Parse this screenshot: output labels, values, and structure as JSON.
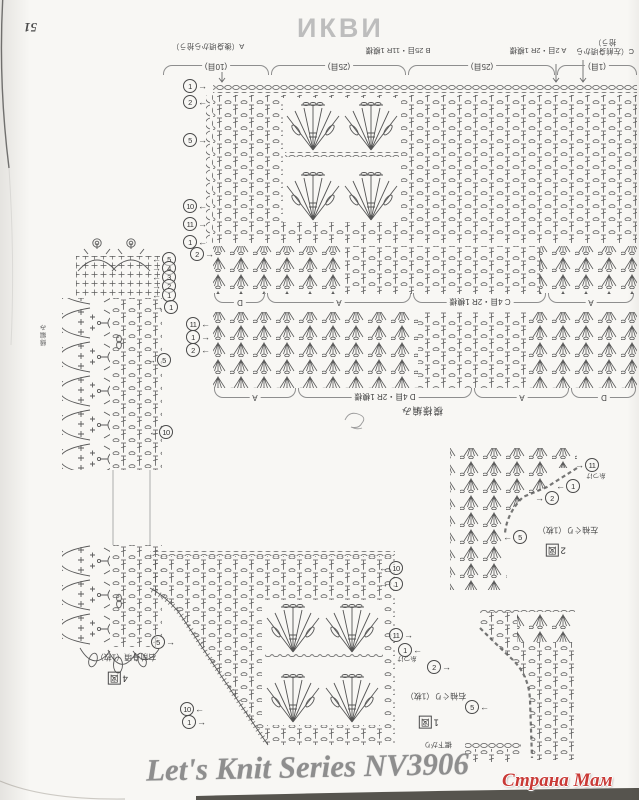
{
  "page": {
    "number": "51",
    "watermark": "ИКВИ",
    "title": "Let's Knit Series NV3906",
    "credit": "Страна Мам"
  },
  "top_chart": {
    "sections": [
      {
        "label": "A（後身頃から拾う）",
        "count": "(10目)"
      },
      {
        "label": "B 25目・11R 1模様",
        "count": "(25目)"
      },
      {
        "label": "A 2目・2R 1模様",
        "count": "(25目)"
      },
      {
        "label": "C（左前身頃から拾う）",
        "count": "(1目)"
      }
    ]
  },
  "band1": {
    "labels": [
      "D",
      "A",
      "C 4目・2R 1模様",
      "A"
    ]
  },
  "band2": {
    "labels": [
      "A",
      "D 4目・2R 1模様",
      "A",
      "D"
    ]
  },
  "captions": {
    "pattern_stitch": "模様編み",
    "hem": "裾下がり",
    "edging": "縁編み"
  },
  "chart4": {
    "caption": "右前身頃（1枚）",
    "fig_num": "4",
    "fig_char": "図"
  },
  "chart2": {
    "caption": "左袖ぐり（1枚）",
    "fig_num": "2",
    "fig_char": "図",
    "note": "糸つけ"
  },
  "chart1": {
    "caption": "右袖ぐり（1枚）",
    "fig_num": "1",
    "fig_char": "図",
    "note": "糸つけ"
  },
  "m": {
    "t1": {
      "n": "1",
      "a": "→"
    },
    "t2": {
      "n": "2",
      "a": "←"
    },
    "t3": {
      "n": "5",
      "a": "→"
    },
    "t4": {
      "n": "10",
      "a": "←"
    },
    "t5": {
      "n": "11",
      "a": "→"
    },
    "t6": {
      "n": "1",
      "a": "←"
    },
    "s0": {
      "n": "2",
      "a": "→"
    },
    "s1": {
      "n": "5",
      "a": "←"
    },
    "s2": {
      "n": "4",
      "a": "→"
    },
    "s3": {
      "n": "3",
      "a": "←"
    },
    "s4": {
      "n": "2",
      "a": "→"
    },
    "s5": {
      "n": "1",
      "a": "←"
    },
    "e1": {
      "n": "1",
      "a": "→"
    },
    "e2": {
      "n": "5",
      "a": "→"
    },
    "e3": {
      "n": "10",
      "a": "←"
    },
    "b1": {
      "n": "11",
      "a": "←"
    },
    "b2": {
      "n": "1",
      "a": "→"
    },
    "b3": {
      "n": "2",
      "a": "←"
    },
    "f1": {
      "n": "5",
      "a": "→"
    },
    "f2": {
      "n": "10",
      "a": "←"
    },
    "f3": {
      "n": "1",
      "a": "→"
    },
    "f4": {
      "n": "10",
      "a": "←"
    },
    "f5": {
      "n": "1",
      "a": "→"
    },
    "g1": {
      "n": "11",
      "a": "→"
    },
    "g2": {
      "n": "1",
      "a": "←"
    },
    "g3": {
      "n": "2",
      "a": "→"
    },
    "g4": {
      "n": "5",
      "a": "←"
    },
    "h1": {
      "n": "11",
      "a": "→"
    },
    "h2": {
      "n": "1",
      "a": "←"
    },
    "h3": {
      "n": "2",
      "a": "→"
    },
    "h4": {
      "n": "5",
      "a": "←"
    }
  }
}
